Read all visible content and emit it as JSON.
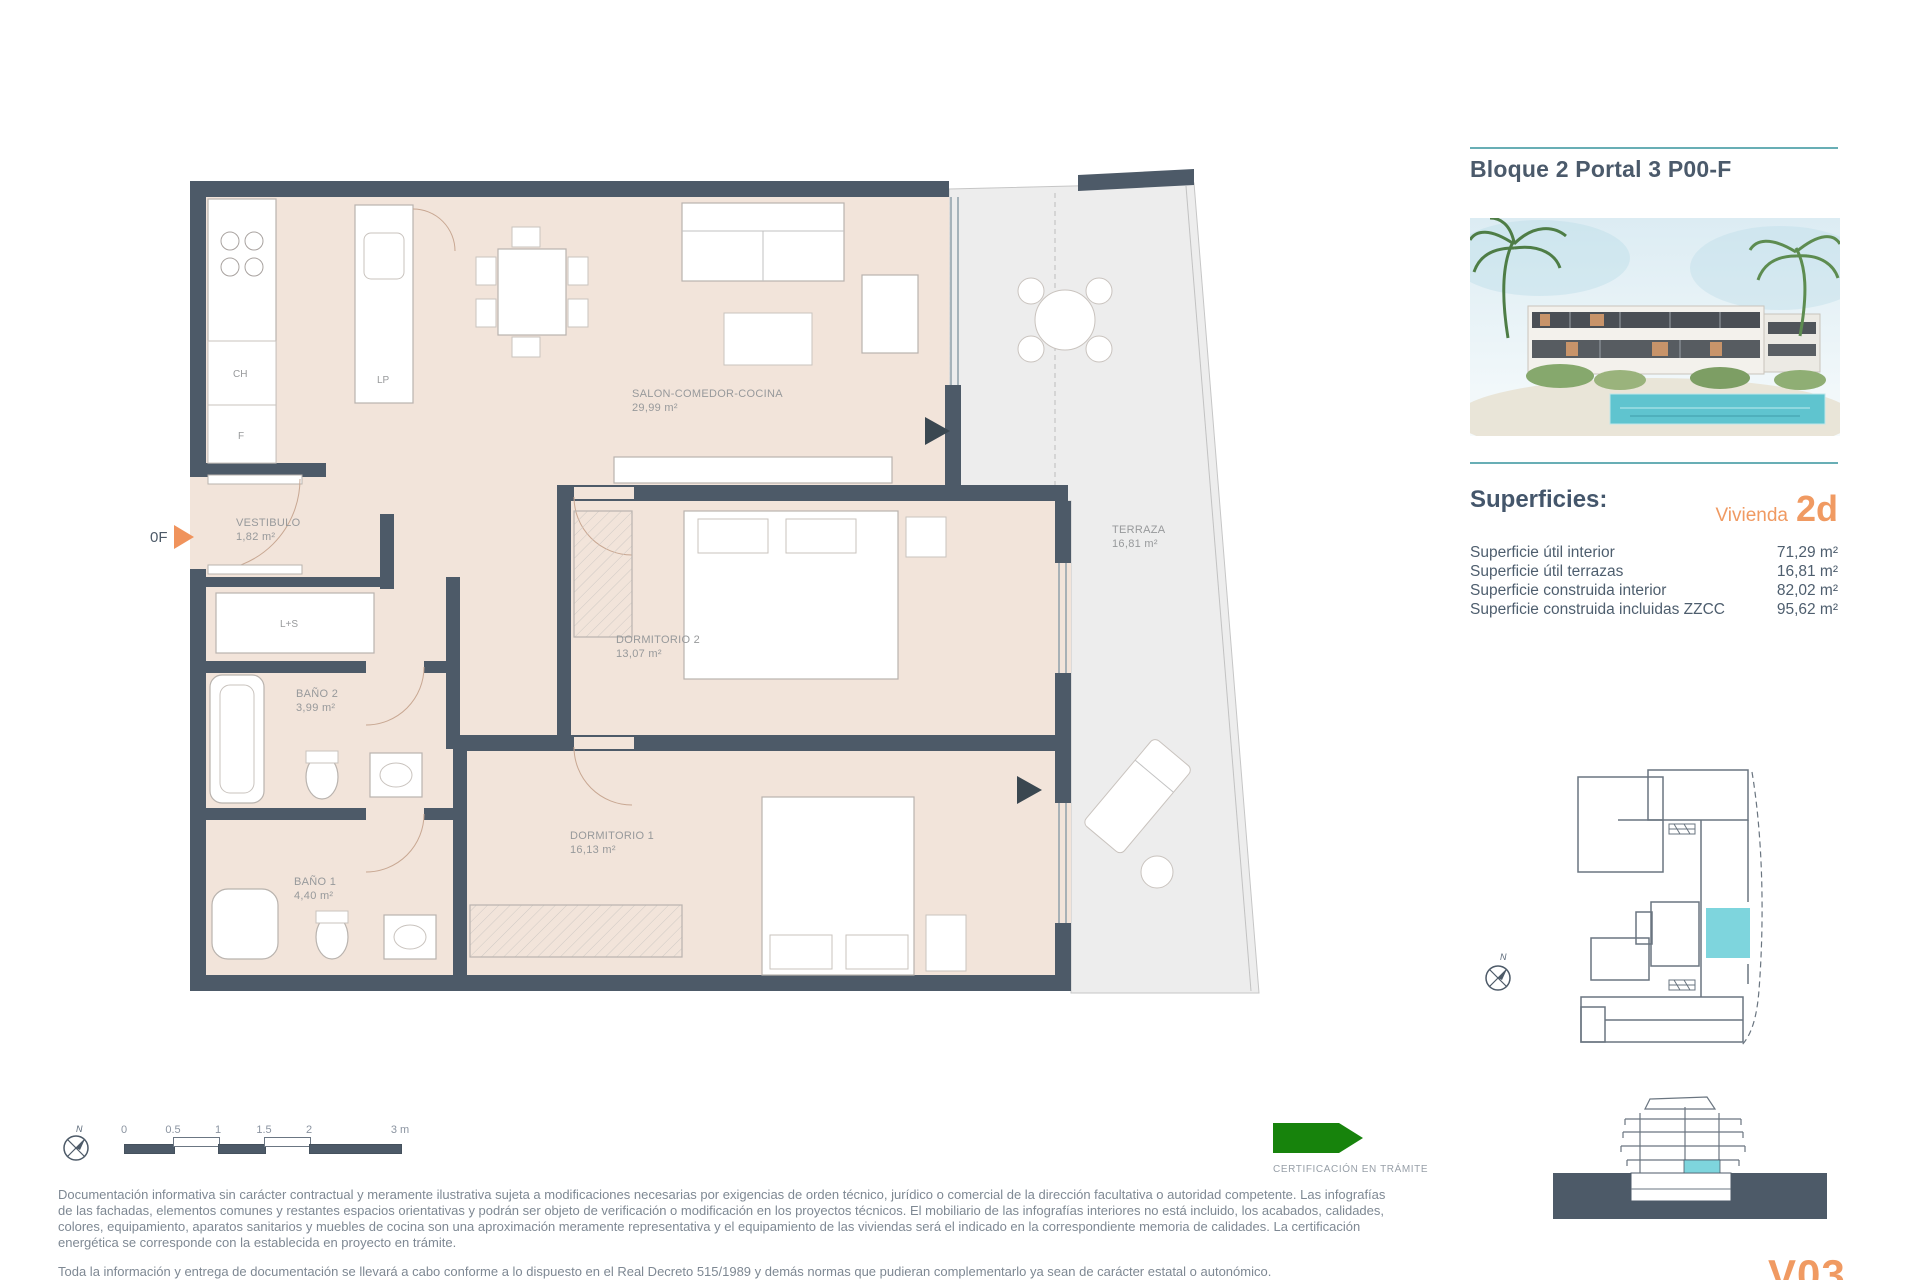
{
  "header": {
    "title": "Bloque 2 Portal 3 P00-F"
  },
  "superficies": {
    "heading": "Superficies:",
    "vivienda_label": "Vivienda",
    "vivienda_code": "2d",
    "rows": [
      {
        "label": "Superficie útil interior",
        "value": "71,29 m²"
      },
      {
        "label": "Superficie útil terrazas",
        "value": "16,81 m²"
      },
      {
        "label": "Superficie construida interior",
        "value": "82,02 m²"
      },
      {
        "label": "Superficie construida incluidas ZZCC",
        "value": "95,62 m²"
      }
    ]
  },
  "floorplan": {
    "entrance_label": "0F",
    "north_label": "N",
    "rooms": [
      {
        "name": "SALON-COMEDOR-COCINA",
        "area": "29,99 m²"
      },
      {
        "name": "VESTIBULO",
        "area": "1,82 m²"
      },
      {
        "name": "DORMITORIO 2",
        "area": "13,07 m²"
      },
      {
        "name": "DORMITORIO 1",
        "area": "16,13 m²"
      },
      {
        "name": "BAÑO 2",
        "area": "3,99 m²"
      },
      {
        "name": "BAÑO 1",
        "area": "4,40 m²"
      },
      {
        "name": "TERRAZA",
        "area": "16,81 m²"
      }
    ],
    "appliances": [
      "CH",
      "F",
      "LP",
      "L+S"
    ]
  },
  "scalebar": {
    "ticks": [
      "0",
      "0.5",
      "1",
      "1.5",
      "2",
      "3 m"
    ]
  },
  "certification": {
    "label": "CERTIFICACIÓN EN TRÁMITE"
  },
  "legal": {
    "paragraph1": "Documentación informativa sin carácter contractual y meramente ilustrativa sujeta a modificaciones necesarias por exigencias de orden técnico, jurídico o comercial de la dirección facultativa o autoridad competente. Las infografías de las fachadas, elementos comunes y restantes espacios orientativas y podrán ser objeto de verificación o modificación en los proyectos técnicos. El mobiliario de las infografías interiores no está incluido, los acabados, calidades, colores, equipamiento, aparatos sanitarios y muebles de cocina son una aproximación meramente representativa y el equipamiento de las viviendas será el indicado en la correspondiente memoria de calidades. La certificación energética se corresponde con la establecida en proyecto en trámite.",
    "paragraph2": "Toda la información y entrega de documentación se llevará a cabo conforme a lo dispuesto en el Real Decreto 515/1989 y demás normas que pudieran complementarlo ya sean de carácter estatal o autonómico."
  },
  "footer": {
    "logo": "V03"
  },
  "colors": {
    "accent_teal": "#68aeb5",
    "accent_orange": "#f09a62",
    "wall": "#4d5a68",
    "floor": "#f2e4da",
    "terrace": "#ededed",
    "unit_highlight": "#7ed5dd",
    "certification_green": "#17830c"
  }
}
